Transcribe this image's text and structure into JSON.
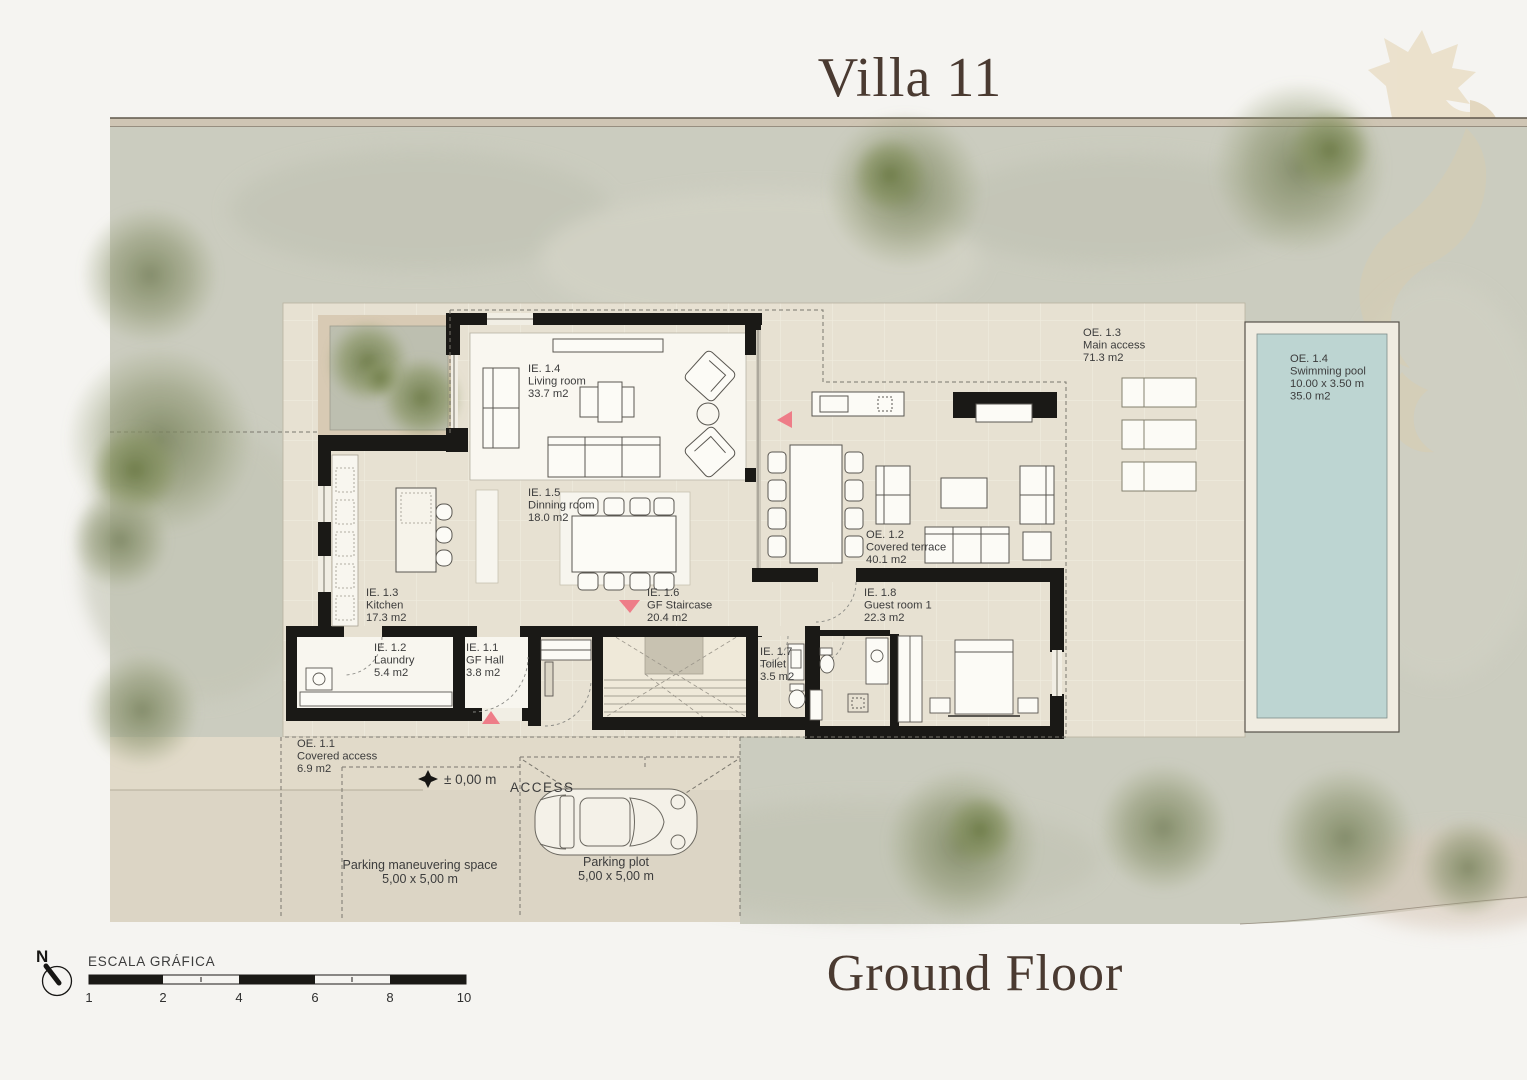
{
  "title": "Villa 11",
  "subtitle": "Ground Floor",
  "rooms": {
    "living": {
      "code": "IE. 1.4",
      "name": "Living room",
      "area": "33.7 m2"
    },
    "dining": {
      "code": "IE. 1.5",
      "name": "Dinning room",
      "area": "18.0 m2"
    },
    "kitchen": {
      "code": "IE. 1.3",
      "name": "Kitchen",
      "area": "17.3 m2"
    },
    "laundry": {
      "code": "IE. 1.2",
      "name": "Laundry",
      "area": "5.4 m2"
    },
    "hall": {
      "code": "IE. 1.1",
      "name": "GF Hall",
      "area": "3.8 m2"
    },
    "staircase": {
      "code": "IE. 1.6",
      "name": "GF Staircase",
      "area": "20.4 m2"
    },
    "toilet": {
      "code": "IE. 1.7",
      "name": "Toilet",
      "area": "3.5 m2"
    },
    "guest": {
      "code": "IE. 1.8",
      "name": "Guest room 1",
      "area": "22.3 m2"
    },
    "terrace": {
      "code": "OE. 1.2",
      "name": "Covered terrace",
      "area": "40.1 m2"
    },
    "main_access": {
      "code": "OE. 1.3",
      "name": "Main access",
      "area": "71.3 m2"
    },
    "pool": {
      "code": "OE. 1.4",
      "name": "Swimming pool",
      "dim": "10.00 x 3.50 m",
      "area": "35.0 m2"
    },
    "covered_access": {
      "code": "OE. 1.1",
      "name": "Covered access",
      "area": "6.9 m2"
    }
  },
  "annotations": {
    "level_marker": "± 0,00 m",
    "access": "ACCESS",
    "parking_maneuvering": {
      "line1": "Parking maneuvering space",
      "line2": "5,00 x 5,00 m"
    },
    "parking_plot": {
      "line1": "Parking plot",
      "line2": "5,00 x 5,00 m"
    }
  },
  "scale_bar": {
    "label": "ESCALA GRÁFICA",
    "ticks": [
      "1",
      "2",
      "4",
      "6",
      "8",
      "10"
    ]
  },
  "north": {
    "label": "N"
  },
  "colors": {
    "paper": "#f5f4f1",
    "band": "#cfc5b4",
    "site": "#cbccbf",
    "platform": "#e7e1d2",
    "driveway": "#dcd5c5",
    "wall": "#1a1916",
    "pool_water": "#bdd5d2",
    "pool_apron": "#f0ece1",
    "accent_pink": "#ee7d88",
    "tree_green": "#7e8a5e",
    "title_brown": "#4a3a31"
  }
}
